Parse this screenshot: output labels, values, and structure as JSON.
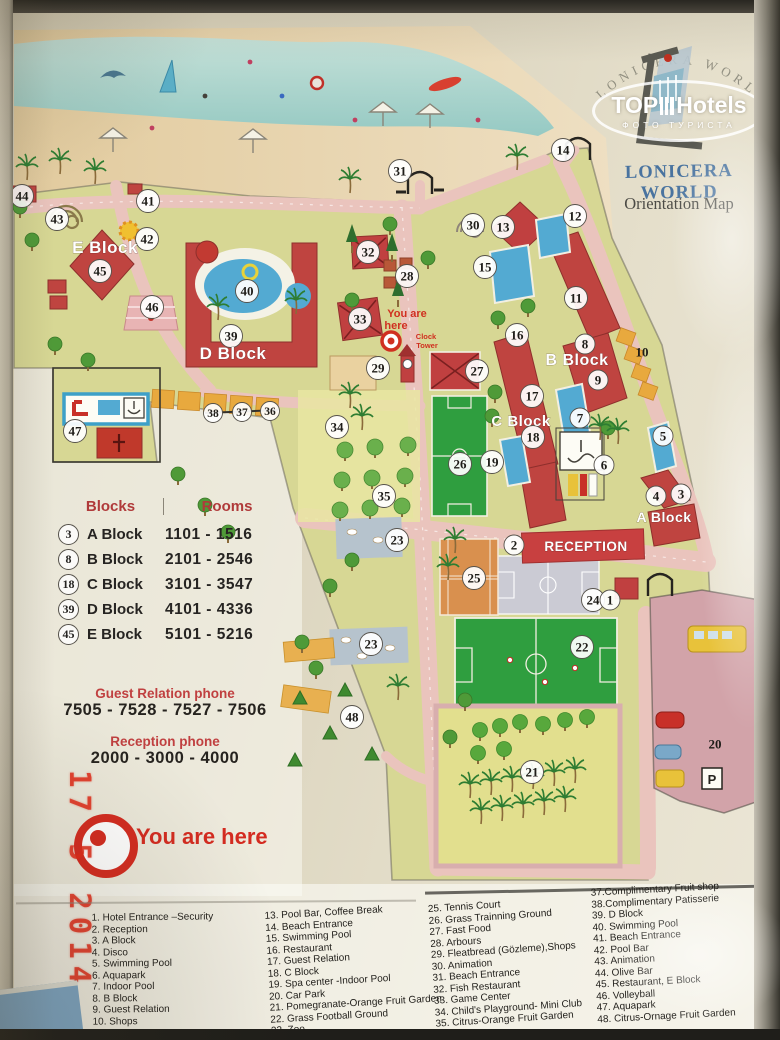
{
  "logo": {
    "arc_text": "LONICERA  WORLD",
    "watermark_top_left": "TOP",
    "watermark_top_right": "Hotels",
    "watermark_bottom": "ФОТО ТУРИСТА",
    "hotel_name": "LONICERA WORLD",
    "subtitle": "Orientation Map"
  },
  "photo": {
    "date_stamp": "17 5 2014"
  },
  "colors": {
    "building_red": "#bf4440",
    "road_pink": "#eac4bd",
    "land_green": "#d7d794",
    "pool_blue": "#53aad2",
    "field_green": "#2f9e3f",
    "court_orange": "#d9904e",
    "legend_red": "#b03a3a",
    "stamp_red": "#e02b18",
    "hotel_blue": "#49739f"
  },
  "blocks_table": {
    "header_blocks": "Blocks",
    "header_rooms": "Rooms",
    "rows": [
      {
        "num": "3",
        "block": "A Block",
        "rooms": "1101 - 1516"
      },
      {
        "num": "8",
        "block": "B Block",
        "rooms": "2101 - 2546"
      },
      {
        "num": "18",
        "block": "C Block",
        "rooms": "3101 - 3547"
      },
      {
        "num": "39",
        "block": "D Block",
        "rooms": "4101 - 4336"
      },
      {
        "num": "45",
        "block": "E Block",
        "rooms": "5101 - 5216"
      }
    ]
  },
  "phones": {
    "guest_relation_label": "Guest Relation phone",
    "guest_relation_numbers": "7505 - 7528 - 7527 - 7506",
    "reception_label": "Reception phone",
    "reception_numbers": "2000 - 3000 - 4000"
  },
  "you_are_here_label": "You are here",
  "map": {
    "badges": [
      {
        "n": "44",
        "x": 22,
        "y": 196
      },
      {
        "n": "43",
        "x": 57,
        "y": 219
      },
      {
        "n": "41",
        "x": 148,
        "y": 201
      },
      {
        "n": "42",
        "x": 147,
        "y": 239
      },
      {
        "n": "45",
        "x": 100,
        "y": 271
      },
      {
        "n": "46",
        "x": 152,
        "y": 307
      },
      {
        "n": "40",
        "x": 247,
        "y": 291
      },
      {
        "n": "39",
        "x": 231,
        "y": 336
      },
      {
        "n": "47",
        "x": 75,
        "y": 431
      },
      {
        "n": "38",
        "x": 213,
        "y": 413,
        "small": true
      },
      {
        "n": "37",
        "x": 242,
        "y": 412,
        "small": true
      },
      {
        "n": "36",
        "x": 270,
        "y": 411,
        "small": true
      },
      {
        "n": "35",
        "x": 384,
        "y": 496
      },
      {
        "n": "34",
        "x": 337,
        "y": 427
      },
      {
        "n": "33",
        "x": 360,
        "y": 319
      },
      {
        "n": "29",
        "x": 378,
        "y": 368
      },
      {
        "n": "32",
        "x": 368,
        "y": 252
      },
      {
        "n": "28",
        "x": 407,
        "y": 276
      },
      {
        "n": "31",
        "x": 400,
        "y": 171
      },
      {
        "n": "30",
        "x": 473,
        "y": 225
      },
      {
        "n": "13",
        "x": 503,
        "y": 227
      },
      {
        "n": "12",
        "x": 575,
        "y": 216
      },
      {
        "n": "14",
        "x": 563,
        "y": 150
      },
      {
        "n": "15",
        "x": 485,
        "y": 267
      },
      {
        "n": "11",
        "x": 576,
        "y": 298
      },
      {
        "n": "8",
        "x": 585,
        "y": 344
      },
      {
        "n": "9",
        "x": 598,
        "y": 380
      },
      {
        "n": "16",
        "x": 517,
        "y": 335
      },
      {
        "n": "10",
        "x": 642,
        "y": 352,
        "plain": true
      },
      {
        "n": "17",
        "x": 532,
        "y": 396
      },
      {
        "n": "7",
        "x": 580,
        "y": 418
      },
      {
        "n": "18",
        "x": 533,
        "y": 437
      },
      {
        "n": "19",
        "x": 492,
        "y": 462
      },
      {
        "n": "26",
        "x": 460,
        "y": 464
      },
      {
        "n": "6",
        "x": 604,
        "y": 465
      },
      {
        "n": "5",
        "x": 663,
        "y": 436
      },
      {
        "n": "4",
        "x": 656,
        "y": 496
      },
      {
        "n": "3",
        "x": 681,
        "y": 494
      },
      {
        "n": "27",
        "x": 477,
        "y": 371
      },
      {
        "n": "2",
        "x": 514,
        "y": 545
      },
      {
        "n": "25",
        "x": 474,
        "y": 578
      },
      {
        "n": "24",
        "x": 593,
        "y": 600
      },
      {
        "n": "1",
        "x": 610,
        "y": 600
      },
      {
        "n": "22",
        "x": 582,
        "y": 647
      },
      {
        "n": "23",
        "x": 397,
        "y": 540
      },
      {
        "n": "23",
        "x": 371,
        "y": 644
      },
      {
        "n": "21",
        "x": 532,
        "y": 772
      },
      {
        "n": "48",
        "x": 352,
        "y": 717
      },
      {
        "n": "20",
        "x": 715,
        "y": 744,
        "plain": true
      }
    ],
    "labels": [
      {
        "text": "E Block",
        "x": 105,
        "y": 253,
        "size": 17,
        "color": "#fff"
      },
      {
        "text": "D Block",
        "x": 233,
        "y": 359,
        "size": 17,
        "color": "#fff"
      },
      {
        "text": "B Block",
        "x": 577,
        "y": 365,
        "size": 16,
        "color": "#fff"
      },
      {
        "text": "C Block",
        "x": 521,
        "y": 426,
        "size": 15,
        "color": "#fff"
      },
      {
        "text": "A Block",
        "x": 664,
        "y": 522,
        "size": 14,
        "color": "#fff"
      },
      {
        "text": "RECEPTION",
        "x": 586,
        "y": 551,
        "size": 13.5,
        "color": "#fff"
      },
      {
        "text": "You are",
        "x": 407,
        "y": 317,
        "size": 11,
        "color": "#d03020"
      },
      {
        "text": "here",
        "x": 396,
        "y": 329,
        "size": 11,
        "color": "#d03020"
      },
      {
        "text": "Clock",
        "x": 426,
        "y": 339,
        "size": 7.5,
        "color": "#d03020"
      },
      {
        "text": "Tower",
        "x": 427,
        "y": 348,
        "size": 7.5,
        "color": "#d03020"
      },
      {
        "text": "P",
        "x": 712,
        "y": 784,
        "size": 13,
        "color": "#26241f"
      }
    ],
    "trees": {
      "round": [
        [
          20,
          207
        ],
        [
          32,
          240
        ],
        [
          55,
          344
        ],
        [
          88,
          360
        ],
        [
          178,
          474
        ],
        [
          205,
          505
        ],
        [
          228,
          532
        ],
        [
          352,
          300
        ],
        [
          390,
          224
        ],
        [
          428,
          258
        ],
        [
          498,
          318
        ],
        [
          492,
          416
        ],
        [
          528,
          306
        ],
        [
          608,
          428
        ],
        [
          352,
          560
        ],
        [
          330,
          586
        ],
        [
          302,
          642
        ],
        [
          316,
          668
        ],
        [
          465,
          700
        ],
        [
          450,
          737
        ],
        [
          495,
          392
        ]
      ],
      "citrus": [
        [
          345,
          450
        ],
        [
          375,
          447
        ],
        [
          408,
          445
        ],
        [
          342,
          480
        ],
        [
          372,
          478
        ],
        [
          405,
          476
        ],
        [
          340,
          510
        ],
        [
          370,
          508
        ],
        [
          402,
          506
        ]
      ],
      "fruit": [
        [
          480,
          730
        ],
        [
          500,
          726
        ],
        [
          520,
          722
        ],
        [
          543,
          724
        ],
        [
          565,
          720
        ],
        [
          587,
          717
        ],
        [
          478,
          753
        ],
        [
          504,
          749
        ]
      ],
      "palm": [
        [
          27,
          172
        ],
        [
          60,
          166
        ],
        [
          95,
          176
        ],
        [
          350,
          185
        ],
        [
          517,
          162
        ],
        [
          218,
          312
        ],
        [
          296,
          306
        ],
        [
          350,
          400
        ],
        [
          362,
          422
        ],
        [
          600,
          432
        ],
        [
          618,
          436
        ],
        [
          455,
          545
        ],
        [
          448,
          572
        ],
        [
          398,
          692
        ]
      ],
      "palm_orchard": [
        [
          470,
          790
        ],
        [
          491,
          787
        ],
        [
          512,
          784
        ],
        [
          533,
          781
        ],
        [
          554,
          778
        ],
        [
          575,
          775
        ],
        [
          481,
          816
        ],
        [
          502,
          813
        ],
        [
          523,
          810
        ],
        [
          544,
          807
        ],
        [
          565,
          804
        ]
      ],
      "pine": [
        [
          352,
          238
        ],
        [
          392,
          247
        ],
        [
          398,
          292
        ]
      ],
      "bush": [
        [
          300,
          700
        ],
        [
          330,
          735
        ],
        [
          295,
          762
        ],
        [
          345,
          692
        ],
        [
          372,
          756
        ]
      ]
    }
  },
  "legend": {
    "columns": [
      [
        "1.  Hotel Entrance –Security",
        "2.  Reception",
        "3.  A Block",
        "4.  Disco",
        "5.  Swimming Pool",
        "6.  Aquapark",
        "7.  Indoor Pool",
        "8.  B Block",
        "9.  Guest Relation",
        "10. Shops"
      ],
      [
        "13. Pool Bar, Coffee Break",
        "14. Beach Entrance",
        "15. Swimming Pool",
        "16. Restaurant",
        "17. Guest Relation",
        "18. C Block",
        "19. Spa center -Indoor Pool",
        "20. Car Park",
        "21. Pomegranate-Orange Fruit Garden",
        "22. Grass Football Ground",
        "23. Zoo",
        "24. Basketball, Volleyball"
      ],
      [
        "25. Tennis Court",
        "26. Grass Trainning Ground",
        "27. Fast Food",
        "28. Arbours",
        "29. Fleatbread (Gözleme),Shops",
        "30. Animation",
        "31. Beach Entrance",
        "32. Fish Restaurant",
        "33. Game Center",
        "34. Child's Playground- Mini Club",
        "35. Citrus-Orange Fruit Garden",
        "36. Tea House"
      ],
      [
        "37.Complimentary Fruit shop",
        "38.Complimentary Patisserie",
        "39. D Block",
        "40. Swimming Pool",
        "41. Beach Entrance",
        "42. Pool Bar",
        "43. Animation",
        "44. Olive Bar",
        "45. Restaurant, E Block",
        "46. Volleyball",
        "47. Aquapark",
        "48. Citrus-Ornage Fruit Garden"
      ]
    ]
  }
}
